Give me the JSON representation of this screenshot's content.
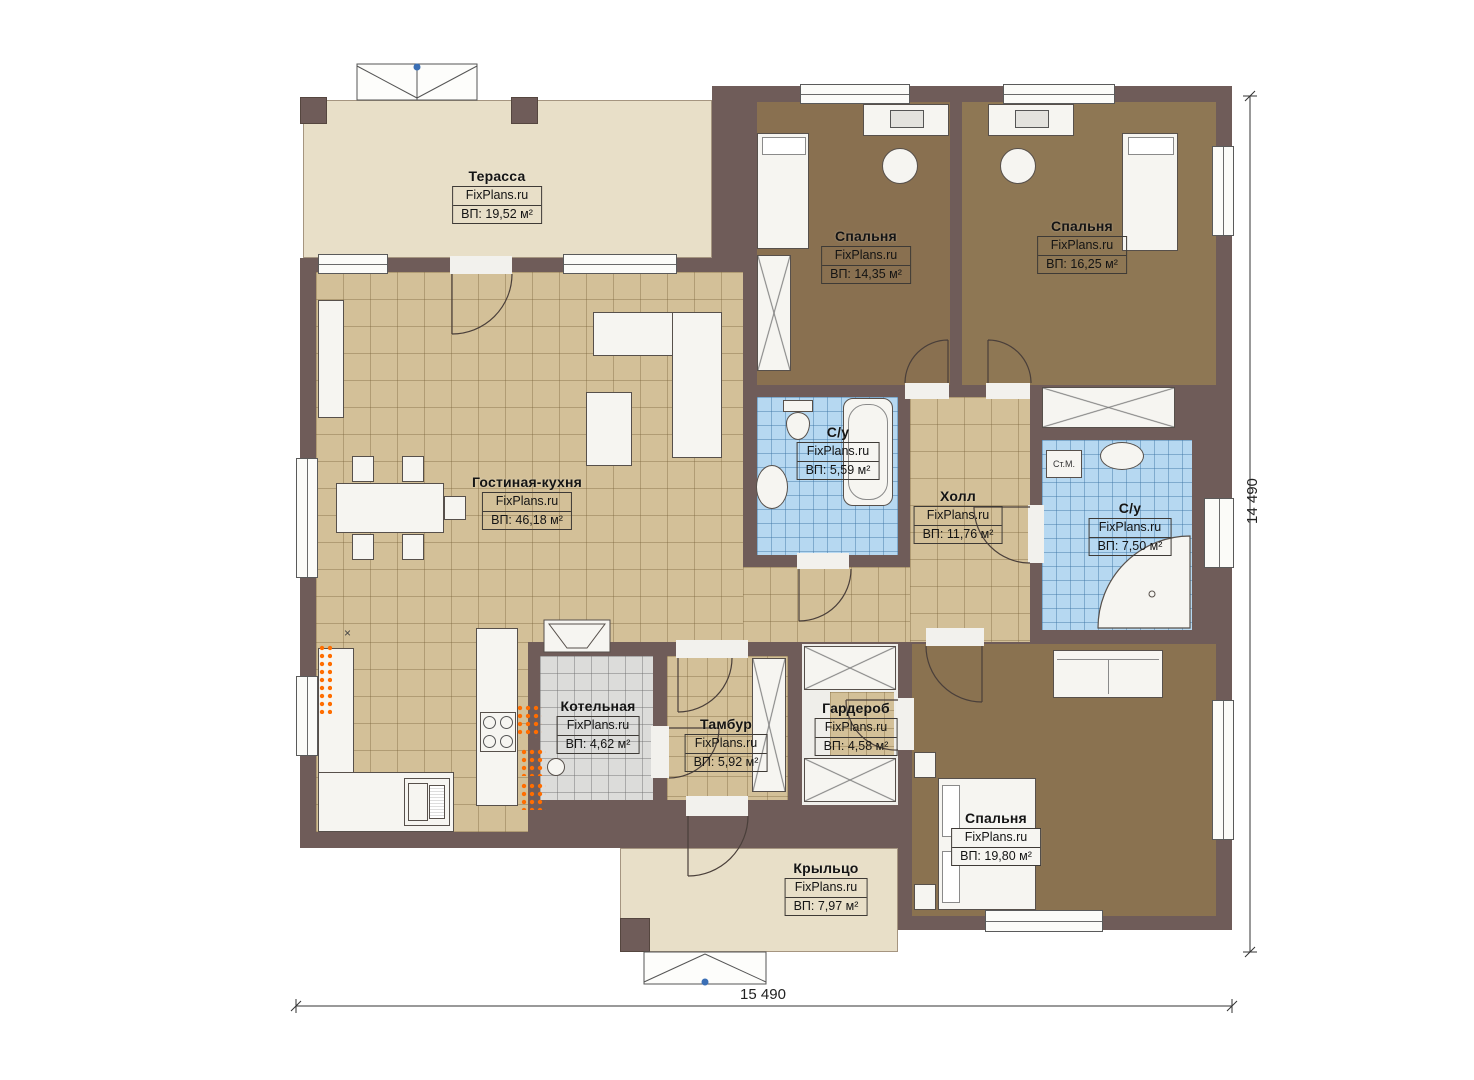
{
  "plan": {
    "watermark": "FixPlans.ru",
    "rooms": [
      {
        "name": "Терасса",
        "area": "ВП: 19,52 м²"
      },
      {
        "name": "Спальня",
        "area": "ВП: 14,35 м²"
      },
      {
        "name": "Спальня",
        "area": "ВП: 16,25 м²"
      },
      {
        "name": "Гостиная-кухня",
        "area": "ВП: 46,18 м²"
      },
      {
        "name": "С/у",
        "area": "ВП: 5,59 м²"
      },
      {
        "name": "Холл",
        "area": "ВП: 11,76 м²"
      },
      {
        "name": "С/у",
        "area": "ВП: 7,50 м²"
      },
      {
        "name": "Котельная",
        "area": "ВП: 4,62 м²"
      },
      {
        "name": "Тамбур",
        "area": "ВП: 5,92 м²"
      },
      {
        "name": "Гардероб",
        "area": "ВП: 4,58 м²"
      },
      {
        "name": "Спальня",
        "area": "ВП: 19,80 м²"
      },
      {
        "name": "Крыльцо",
        "area": "ВП: 7,97 м²"
      }
    ],
    "annotations": {
      "washer": "Ст.М.",
      "x_marker": "×"
    },
    "dimensions": {
      "width": "15 490",
      "height": "14 490"
    }
  }
}
